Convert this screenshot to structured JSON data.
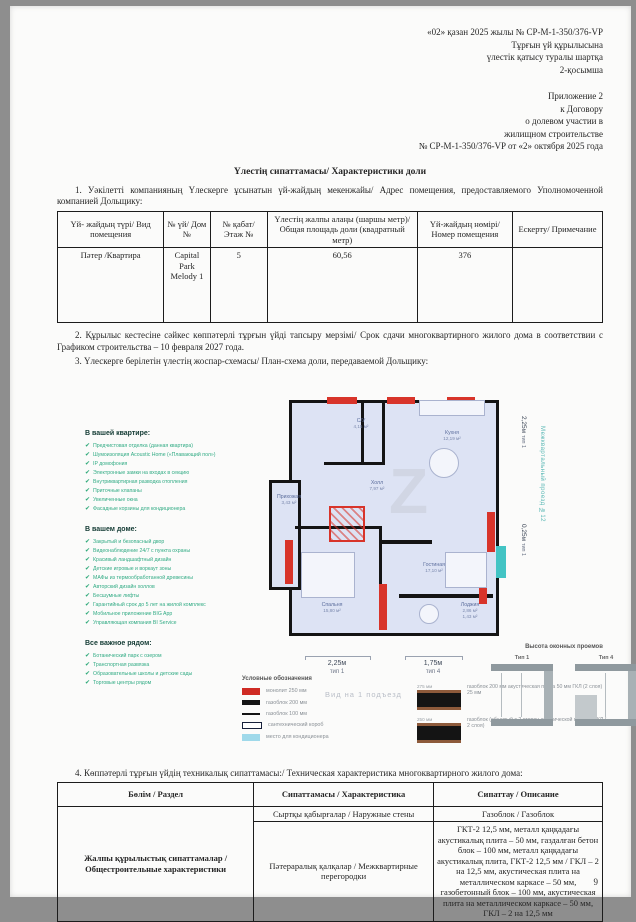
{
  "header": {
    "kk": [
      "«02» қазан 2025 жылы № СР-М-1-350/376-VP",
      "Тұрғын үй құрылысына",
      "үлестік қатысу туралы шартқа",
      "2-қосымша"
    ],
    "ru": [
      "Приложение 2",
      "к Договору",
      "о долевом участии в",
      "жилищном строительстве",
      "№ СР-М-1-350/376-VP от «2» октября 2025 года"
    ]
  },
  "title": "Үлестің сипаттамасы/ Характеристики доли",
  "para1": "1. Уәкілетті компанияның Үлескерге ұсынатын үй-жайдың мекенжайы/ Адрес помещения, предоставляемого Уполномоченной компанией Дольщику:",
  "table1": {
    "headers": [
      "Үй- жайдың түрі/ Вид помещения",
      "№ үй/ Дом №",
      "№ қабат/ Этаж №",
      "Үлестің жалпы алаңы (шаршы метр)/ Общая площадь доли (квадратный метр)",
      "Үй-жайдың нөмірі/ Номер помещения",
      "Ескерту/ Примечание"
    ],
    "row": [
      "Пәтер /Квартира",
      "Capital Park Melody 1",
      "5",
      "60,56",
      "376",
      ""
    ]
  },
  "para2": "2. Құрылыс кестесіне сәйкес көппәтерлі тұрғын үйді тапсыру мерзімі/ Срок сдачи многоквартирного жилого дома в соответствии с Графиком строительства – 10 февраля 2027 года.",
  "para3": "3. Үлескерге берілетін үлестің жоспар-схемасы/ План-схема доли, передаваемой Дольщику:",
  "figure": {
    "checklist": [
      {
        "heading": "В вашей квартире:",
        "items": [
          "Предчистовая отделка (данная квартира)",
          "Шумоизоляция Acoustic Home («Плавающий пол»)",
          "IP домофония",
          "Электронные замки на входах в секцию",
          "Внутриквартирная разводка отопления",
          "Приточные клапаны",
          "Увеличенные окна",
          "Фасадные корзины для кондиционера"
        ]
      },
      {
        "heading": "В вашем доме:",
        "items": [
          "Закрытый и безопасный двор",
          "Видеонаблюдение 24/7 с пункта охраны",
          "Красивый ландшафтный дизайн",
          "Детские игровые и воркаут зоны",
          "МАФы из термообработанной древесины",
          "Авторский дизайн холлов",
          "Бесшумные лифты",
          "Гарантийный срок до 5 лет на жилой комплекс",
          "Мобильное приложение BIG App",
          "Управляющая компания BI Service"
        ]
      },
      {
        "heading": "Все важное рядом:",
        "items": [
          "Ботанический парк с озером",
          "Транспортная развязка",
          "Образовательные школы и детские сады",
          "Торговые центры рядом"
        ]
      }
    ],
    "rooms": {
      "wc": {
        "name": "С/У",
        "area": "4,15 м²"
      },
      "kitchen": {
        "name": "Кухня",
        "area": "12,19 м²"
      },
      "hallway": {
        "name": "Прихожая",
        "area": "3,43 м²"
      },
      "hall": {
        "name": "Холл",
        "area": "7,97 м²"
      },
      "bedroom": {
        "name": "Спальня",
        "area": "15,80 м²"
      },
      "living": {
        "name": "Гостиная",
        "area": "17,10 м²"
      },
      "loggia": {
        "name": "Лоджия",
        "area": "2,86 м²",
        "area2": "1,43 м²"
      }
    },
    "dims": {
      "right_top": "2,25м",
      "right_top_type": "тип 1",
      "right_mid": "0,25м",
      "right_mid_type": "тип 1",
      "bottom_left": "2,25м",
      "bottom_left_type": "тип 1",
      "bottom_right": "1,75м",
      "bottom_right_type": "тип 4"
    },
    "street": "Межквартальный проезд №12",
    "caption": "Вид на 1 подъезд",
    "watermark": "Z",
    "legend": {
      "title": "Условные обозначения",
      "items": [
        "монолит 250 мм",
        "газоблок 200 мм",
        "газоблок 100 мм",
        "сантехнический короб",
        "место для кондиционера"
      ],
      "wall_sections": [
        {
          "size": "275 мм",
          "label": "газоблок 200 мм акустическая плита 50 мм ГКЛ (2 слоя) 25 мм"
        },
        {
          "size": "250 мм",
          "label": "газоблок (обшитый с 2 сторон акустической плитой) ГКЛ ( 2 слоя)"
        }
      ]
    },
    "window_heights": {
      "title": "Высота оконных проемов",
      "type1": "Тип 1",
      "type2": "Тип 4"
    }
  },
  "para4": "4. Көппәтерлі тұрғын үйдің техникалық сипаттамасы:/ Техническая характеристика многоквартирного жилого дома:",
  "table2": {
    "headers": [
      "Бөлім / Раздел",
      "Сипаттамасы / Характеристика",
      "Сипаттау / Описание"
    ],
    "section": "Жалпы құрылыстық сипаттамалар / Общестроительные характеристики",
    "rows": [
      {
        "char": "Сыртқы қабырғалар / Наружные стены",
        "desc": "Газоблок / Газоблок"
      },
      {
        "char": "Пәтераралық қалқалар / Межквартирные перегородки",
        "desc": "ГКТ-2 12,5 мм, металл қаңқадағы акустикалық плита – 50 мм, газдалған бетон блок – 100 мм, металл қаңқадағы акустикалық плита, ГКТ-2 12,5 мм / ГКЛ – 2 на 12,5 мм, акустическая плита на металлическом каркасе – 50 мм, газобетонный блок – 100 мм, акустическая плита на металлическом каркасе – 50 мм, ГКЛ – 2 на 12,5 мм"
      }
    ]
  },
  "page_number": "9"
}
